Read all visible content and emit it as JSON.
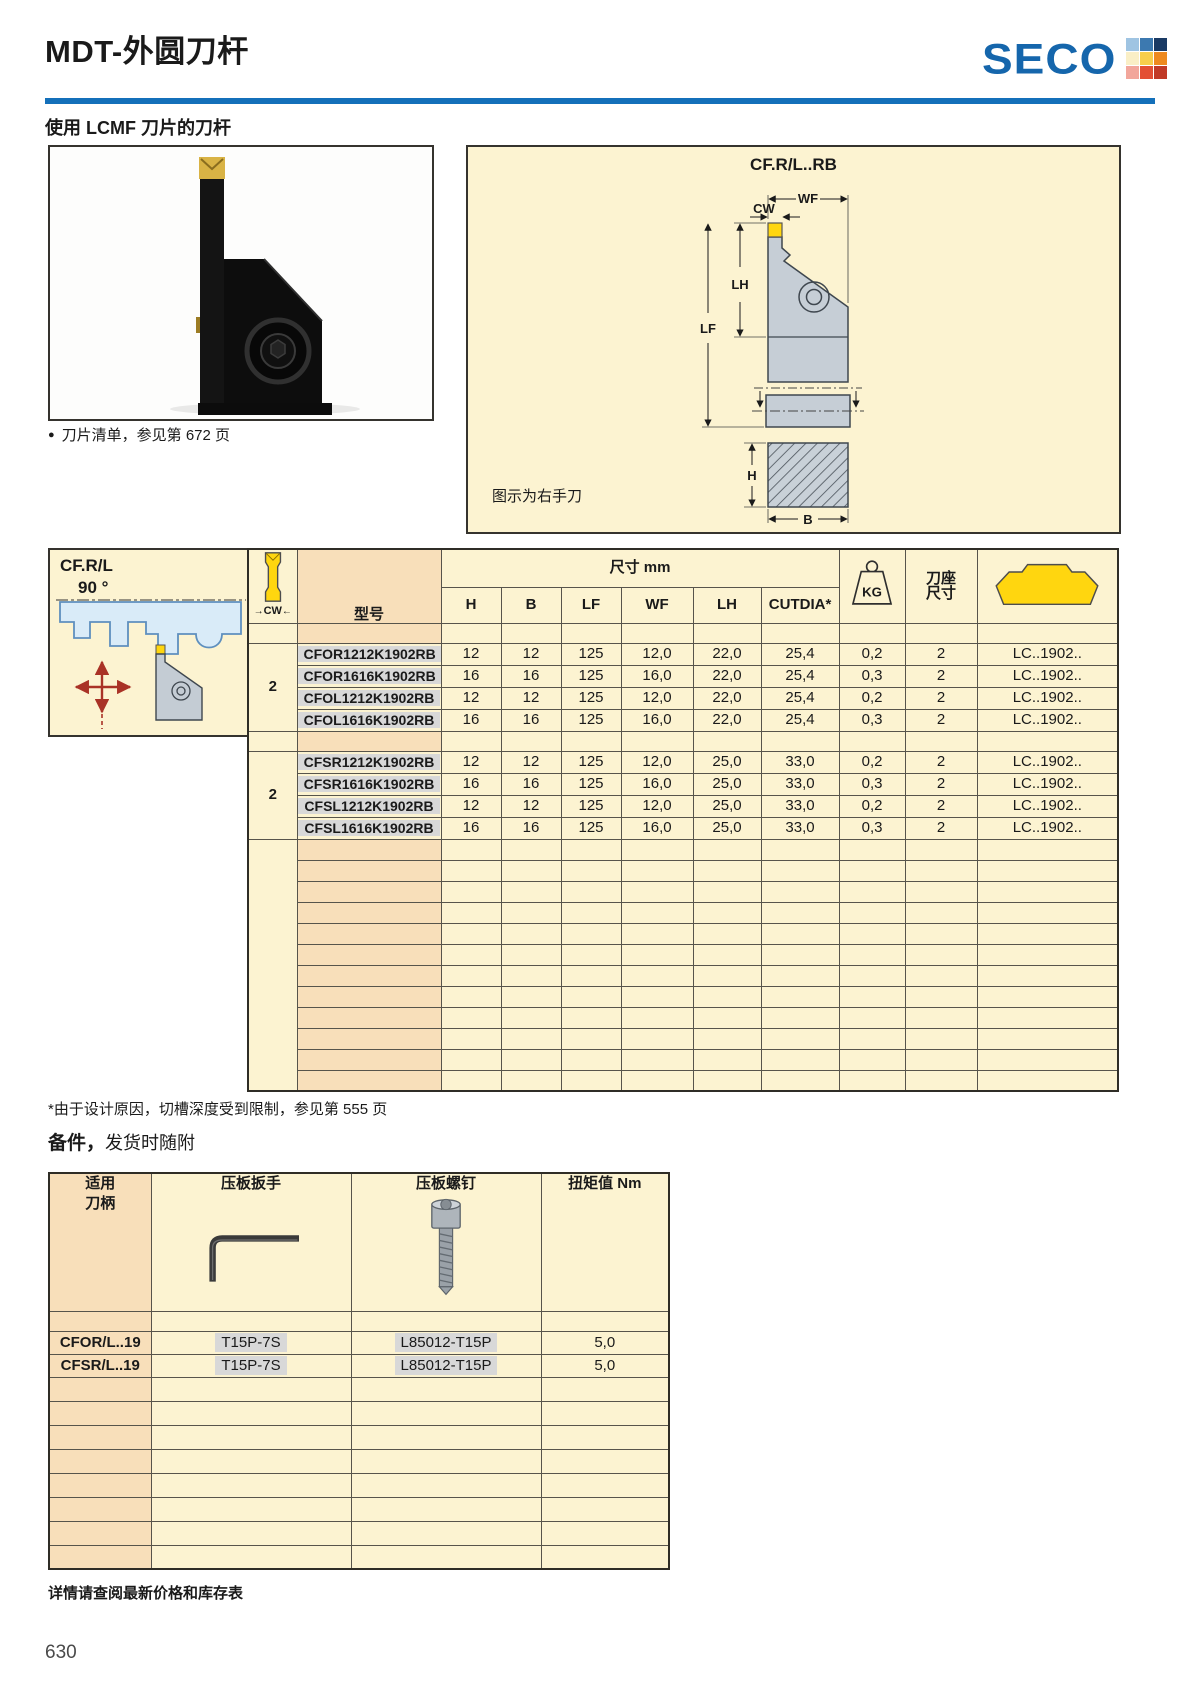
{
  "colors": {
    "brand_blue": "#1566AC",
    "rule_blue": "#1470BA",
    "cream": "#FCF3D1",
    "orange_column": "#F8DFBA",
    "insert_yellow": "#FFD60F",
    "highlight_gray": "#D8D8D8",
    "red_arrow": "#A93226"
  },
  "header": {
    "title": "MDT-外圆刀杆",
    "logo_text": "SECO",
    "logo_grid_colors": [
      "#9FC4E2",
      "#3C79B0",
      "#1A3A64",
      "#FAEFC6",
      "#F7CE4C",
      "#EE8A1F",
      "#F2A69B",
      "#E34F34",
      "#C13A27"
    ]
  },
  "intro": {
    "subtitle": "使用 LCMF 刀片的刀杆",
    "insert_note_bullet": "●",
    "insert_note": "刀片清单，参见第 672 页"
  },
  "diagram": {
    "title": "CF.R/L..RB",
    "note": "图示为右手刀",
    "dims": {
      "wf": "WF",
      "cw": "CW",
      "lh": "LH",
      "lf": "LF",
      "h": "H",
      "b": "B"
    }
  },
  "side_box": {
    "code": "CF.R/L",
    "angle": "90 °"
  },
  "main_table": {
    "model_label": "型号",
    "dim_group_label": "尺寸 mm",
    "cw_label": "CW",
    "col_labels": [
      "H",
      "B",
      "LF",
      "WF",
      "LH",
      "CUTDIA*"
    ],
    "kg_label": "KG",
    "seat_label_1": "刀座",
    "seat_label_2": "尺寸",
    "groups": [
      {
        "cw": "2",
        "rows": [
          {
            "model": "CFOR1212K1902RB",
            "h": "12",
            "b": "12",
            "lf": "125",
            "wf": "12,0",
            "lh": "22,0",
            "cutdia": "25,4",
            "kg": "0,2",
            "seat": "2",
            "insert": "LC..1902.."
          },
          {
            "model": "CFOR1616K1902RB",
            "h": "16",
            "b": "16",
            "lf": "125",
            "wf": "16,0",
            "lh": "22,0",
            "cutdia": "25,4",
            "kg": "0,3",
            "seat": "2",
            "insert": "LC..1902.."
          },
          {
            "model": "CFOL1212K1902RB",
            "h": "12",
            "b": "12",
            "lf": "125",
            "wf": "12,0",
            "lh": "22,0",
            "cutdia": "25,4",
            "kg": "0,2",
            "seat": "2",
            "insert": "LC..1902.."
          },
          {
            "model": "CFOL1616K1902RB",
            "h": "16",
            "b": "16",
            "lf": "125",
            "wf": "16,0",
            "lh": "22,0",
            "cutdia": "25,4",
            "kg": "0,3",
            "seat": "2",
            "insert": "LC..1902.."
          }
        ]
      },
      {
        "cw": "2",
        "rows": [
          {
            "model": "CFSR1212K1902RB",
            "h": "12",
            "b": "12",
            "lf": "125",
            "wf": "12,0",
            "lh": "25,0",
            "cutdia": "33,0",
            "kg": "0,2",
            "seat": "2",
            "insert": "LC..1902.."
          },
          {
            "model": "CFSR1616K1902RB",
            "h": "16",
            "b": "16",
            "lf": "125",
            "wf": "16,0",
            "lh": "25,0",
            "cutdia": "33,0",
            "kg": "0,3",
            "seat": "2",
            "insert": "LC..1902.."
          },
          {
            "model": "CFSL1212K1902RB",
            "h": "12",
            "b": "12",
            "lf": "125",
            "wf": "12,0",
            "lh": "25,0",
            "cutdia": "33,0",
            "kg": "0,2",
            "seat": "2",
            "insert": "LC..1902.."
          },
          {
            "model": "CFSL1616K1902RB",
            "h": "16",
            "b": "16",
            "lf": "125",
            "wf": "16,0",
            "lh": "25,0",
            "cutdia": "33,0",
            "kg": "0,3",
            "seat": "2",
            "insert": "LC..1902.."
          }
        ]
      }
    ],
    "footnote": "*由于设计原因，切槽深度受到限制，参见第 555 页"
  },
  "accessories": {
    "heading_bold": "备件，",
    "heading_rest": "发货时随附",
    "col1_label_1": "适用",
    "col1_label_2": "刀柄",
    "col2_label": "压板扳手",
    "col3_label": "压板螺钉",
    "col4_label": "扭矩值 Nm",
    "rows": [
      {
        "holder": "CFOR/L..19",
        "wrench": "T15P-7S",
        "screw": "L85012-T15P",
        "torque": "5,0"
      },
      {
        "holder": "CFSR/L..19",
        "wrench": "T15P-7S",
        "screw": "L85012-T15P",
        "torque": "5,0"
      }
    ],
    "note": "详情请查阅最新价格和库存表"
  },
  "page": {
    "number": "630"
  }
}
